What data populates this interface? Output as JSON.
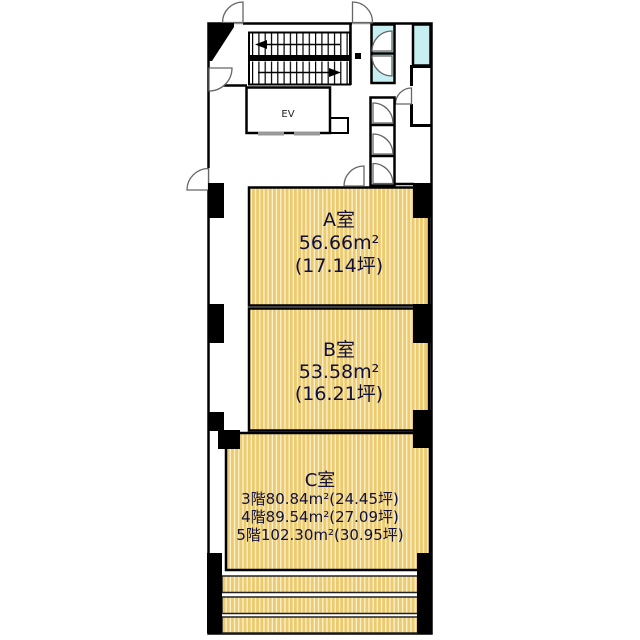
{
  "plan": {
    "room_a": {
      "name": "A室",
      "area": "56.66m²",
      "tsubo": "(17.14坪)"
    },
    "room_b": {
      "name": "B室",
      "area": "53.58m²",
      "tsubo": "(16.21坪)"
    },
    "room_c": {
      "name": "C室",
      "floor3": "3階80.84m²(24.45坪)",
      "floor4": "4階89.54m²(27.09坪)",
      "floor5": "5階102.30m²(30.95坪)"
    },
    "elevator": "EV"
  },
  "colors": {
    "tatami_dark": "#ecca6f",
    "tatami_light": "#faf2cf",
    "wet_area": "#c7eff2",
    "wall": "#000000",
    "label": "#10103a"
  }
}
